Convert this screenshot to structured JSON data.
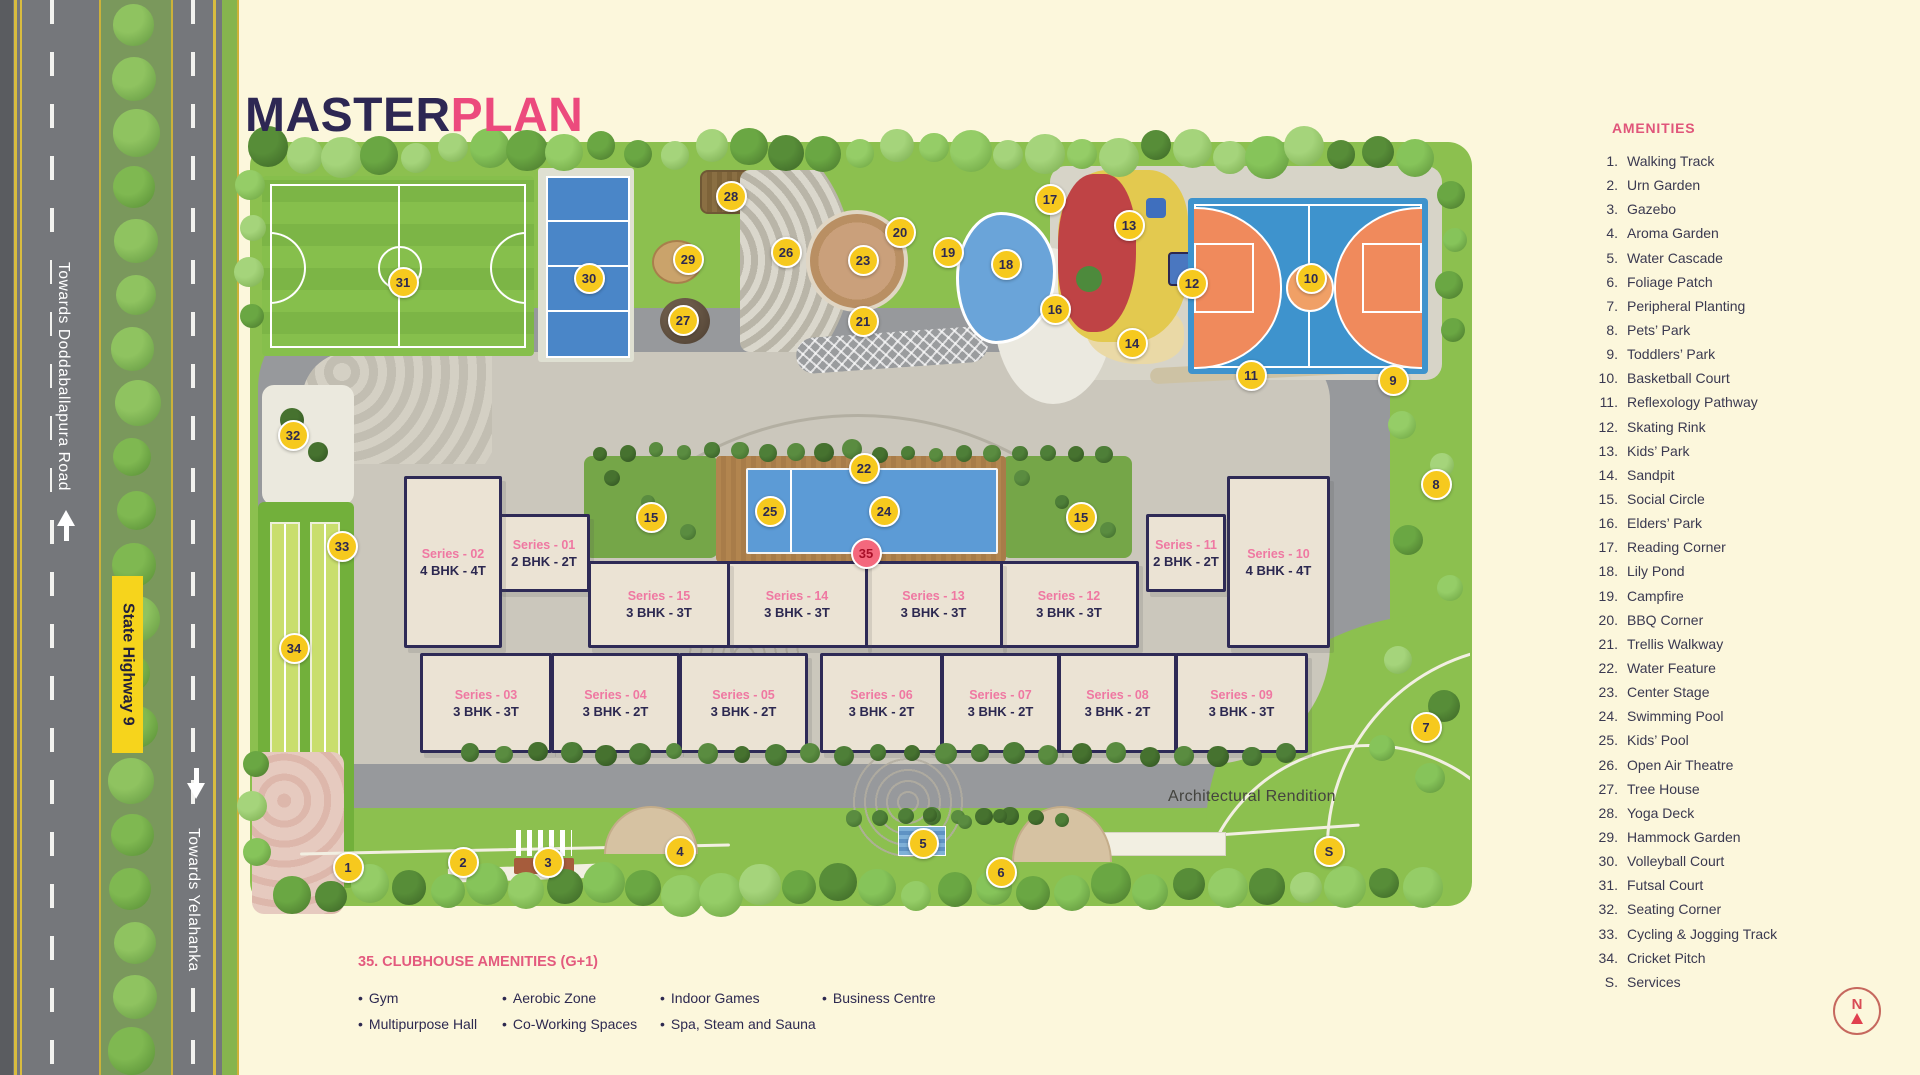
{
  "title": {
    "master": "MASTER",
    "plan": "PLAN"
  },
  "legend": {
    "header": "AMENITIES",
    "items": [
      {
        "n": "1.",
        "label": "Walking Track"
      },
      {
        "n": "2.",
        "label": "Urn Garden"
      },
      {
        "n": "3.",
        "label": "Gazebo"
      },
      {
        "n": "4.",
        "label": "Aroma Garden"
      },
      {
        "n": "5.",
        "label": "Water Cascade"
      },
      {
        "n": "6.",
        "label": "Foliage Patch"
      },
      {
        "n": "7.",
        "label": "Peripheral Planting"
      },
      {
        "n": "8.",
        "label": "Pets’ Park"
      },
      {
        "n": "9.",
        "label": "Toddlers’ Park"
      },
      {
        "n": "10.",
        "label": "Basketball Court"
      },
      {
        "n": "11.",
        "label": "Reflexology Pathway"
      },
      {
        "n": "12.",
        "label": "Skating Rink"
      },
      {
        "n": "13.",
        "label": "Kids’ Park"
      },
      {
        "n": "14.",
        "label": "Sandpit"
      },
      {
        "n": "15.",
        "label": "Social Circle"
      },
      {
        "n": "16.",
        "label": "Elders’ Park"
      },
      {
        "n": "17.",
        "label": "Reading Corner"
      },
      {
        "n": "18.",
        "label": "Lily Pond"
      },
      {
        "n": "19.",
        "label": "Campfire"
      },
      {
        "n": "20.",
        "label": "BBQ Corner"
      },
      {
        "n": "21.",
        "label": "Trellis Walkway"
      },
      {
        "n": "22.",
        "label": "Water Feature"
      },
      {
        "n": "23.",
        "label": "Center Stage"
      },
      {
        "n": "24.",
        "label": "Swimming Pool"
      },
      {
        "n": "25.",
        "label": "Kids’ Pool"
      },
      {
        "n": "26.",
        "label": "Open Air Theatre"
      },
      {
        "n": "27.",
        "label": "Tree House"
      },
      {
        "n": "28.",
        "label": "Yoga Deck"
      },
      {
        "n": "29.",
        "label": "Hammock Garden"
      },
      {
        "n": "30.",
        "label": "Volleyball Court"
      },
      {
        "n": "31.",
        "label": "Futsal Court"
      },
      {
        "n": "32.",
        "label": "Seating Corner"
      },
      {
        "n": "33.",
        "label": "Cycling & Jogging Track"
      },
      {
        "n": "34.",
        "label": "Cricket Pitch"
      },
      {
        "n": "S.",
        "label": "Services"
      }
    ]
  },
  "clubhouse": {
    "heading": "35. CLUBHOUSE AMENITIES (G+1)",
    "columns": [
      [
        "Gym",
        "Multipurpose Hall"
      ],
      [
        "Aerobic Zone",
        "Co-Working Spaces"
      ],
      [
        "Indoor Games",
        "Spa, Steam and Sauna"
      ],
      [
        "Business Centre"
      ]
    ]
  },
  "roads": {
    "left_label": "Towards Doddaballapura Road",
    "highway_sign": "State Highway 9",
    "bottom_label": "Towards Yelahanka"
  },
  "map": {
    "note": "Architectural Rendition",
    "north": "N",
    "markers": [
      {
        "n": "1",
        "x": 346,
        "y": 865
      },
      {
        "n": "2",
        "x": 461,
        "y": 860
      },
      {
        "n": "3",
        "x": 546,
        "y": 860
      },
      {
        "n": "4",
        "x": 678,
        "y": 849
      },
      {
        "n": "5",
        "x": 921,
        "y": 841
      },
      {
        "n": "6",
        "x": 999,
        "y": 870
      },
      {
        "n": "7",
        "x": 1424,
        "y": 725
      },
      {
        "n": "8",
        "x": 1434,
        "y": 482
      },
      {
        "n": "9",
        "x": 1391,
        "y": 378
      },
      {
        "n": "10",
        "x": 1309,
        "y": 276
      },
      {
        "n": "11",
        "x": 1249,
        "y": 373
      },
      {
        "n": "12",
        "x": 1190,
        "y": 281
      },
      {
        "n": "13",
        "x": 1127,
        "y": 223
      },
      {
        "n": "14",
        "x": 1130,
        "y": 341
      },
      {
        "n": "15",
        "x": 649,
        "y": 515
      },
      {
        "n": "15",
        "x": 1079,
        "y": 515
      },
      {
        "n": "16",
        "x": 1053,
        "y": 307
      },
      {
        "n": "17",
        "x": 1048,
        "y": 197
      },
      {
        "n": "18",
        "x": 1004,
        "y": 262
      },
      {
        "n": "19",
        "x": 946,
        "y": 250
      },
      {
        "n": "20",
        "x": 898,
        "y": 230
      },
      {
        "n": "21",
        "x": 861,
        "y": 319
      },
      {
        "n": "22",
        "x": 862,
        "y": 466
      },
      {
        "n": "23",
        "x": 861,
        "y": 258
      },
      {
        "n": "24",
        "x": 882,
        "y": 509
      },
      {
        "n": "25",
        "x": 768,
        "y": 509
      },
      {
        "n": "26",
        "x": 784,
        "y": 250
      },
      {
        "n": "27",
        "x": 681,
        "y": 318
      },
      {
        "n": "28",
        "x": 729,
        "y": 194
      },
      {
        "n": "29",
        "x": 686,
        "y": 257
      },
      {
        "n": "30",
        "x": 587,
        "y": 276
      },
      {
        "n": "31",
        "x": 401,
        "y": 280
      },
      {
        "n": "32",
        "x": 291,
        "y": 433
      },
      {
        "n": "33",
        "x": 340,
        "y": 544
      },
      {
        "n": "34",
        "x": 292,
        "y": 646
      },
      {
        "n": "35",
        "x": 864,
        "y": 551,
        "variant": "red"
      },
      {
        "n": "S",
        "x": 1327,
        "y": 849
      }
    ],
    "buildings": [
      {
        "series": "Series - 01",
        "bhk": "2 BHK - 2T",
        "x": 498,
        "y": 514,
        "w": 86,
        "h": 72
      },
      {
        "series": "Series - 02",
        "bhk": "4 BHK - 4T",
        "x": 404,
        "y": 476,
        "w": 92,
        "h": 166
      },
      {
        "series": "Series - 03",
        "bhk": "3 BHK - 3T",
        "x": 420,
        "y": 653,
        "w": 126,
        "h": 94
      },
      {
        "series": "Series - 04",
        "bhk": "3 BHK - 2T",
        "x": 551,
        "y": 653,
        "w": 123,
        "h": 94
      },
      {
        "series": "Series - 05",
        "bhk": "3 BHK - 2T",
        "x": 679,
        "y": 653,
        "w": 123,
        "h": 94
      },
      {
        "series": "Series - 06",
        "bhk": "3 BHK - 2T",
        "x": 820,
        "y": 653,
        "w": 117,
        "h": 94
      },
      {
        "series": "Series - 07",
        "bhk": "3 BHK - 2T",
        "x": 941,
        "y": 653,
        "w": 113,
        "h": 94
      },
      {
        "series": "Series - 08",
        "bhk": "3 BHK - 2T",
        "x": 1058,
        "y": 653,
        "w": 113,
        "h": 94
      },
      {
        "series": "Series - 09",
        "bhk": "3 BHK - 3T",
        "x": 1175,
        "y": 653,
        "w": 127,
        "h": 94
      },
      {
        "series": "Series - 10",
        "bhk": "4 BHK - 4T",
        "x": 1227,
        "y": 476,
        "w": 97,
        "h": 166
      },
      {
        "series": "Series - 11",
        "bhk": "2 BHK - 2T",
        "x": 1146,
        "y": 514,
        "w": 74,
        "h": 72
      },
      {
        "series": "Series - 12",
        "bhk": "3 BHK - 3T",
        "x": 999,
        "y": 561,
        "w": 134,
        "h": 81
      },
      {
        "series": "Series - 13",
        "bhk": "3 BHK - 3T",
        "x": 864,
        "y": 561,
        "w": 133,
        "h": 81
      },
      {
        "series": "Series - 14",
        "bhk": "3 BHK - 3T",
        "x": 726,
        "y": 561,
        "w": 136,
        "h": 81
      },
      {
        "series": "Series - 15",
        "bhk": "3 BHK - 3T",
        "x": 588,
        "y": 561,
        "w": 136,
        "h": 81
      }
    ]
  },
  "colors": {
    "accent_pink": "#ec4a7d",
    "navy": "#2d2753",
    "marker_yellow": "#f6c91e",
    "marker_red": "#f4687d",
    "highway_sign_yellow": "#f6d41c",
    "pool_blue": "#5c9bd6",
    "court_blue": "#3e93cd",
    "court_orange": "#f08a5c",
    "site_green": "#8cc04f",
    "building_fill": "#ebe3d4"
  }
}
